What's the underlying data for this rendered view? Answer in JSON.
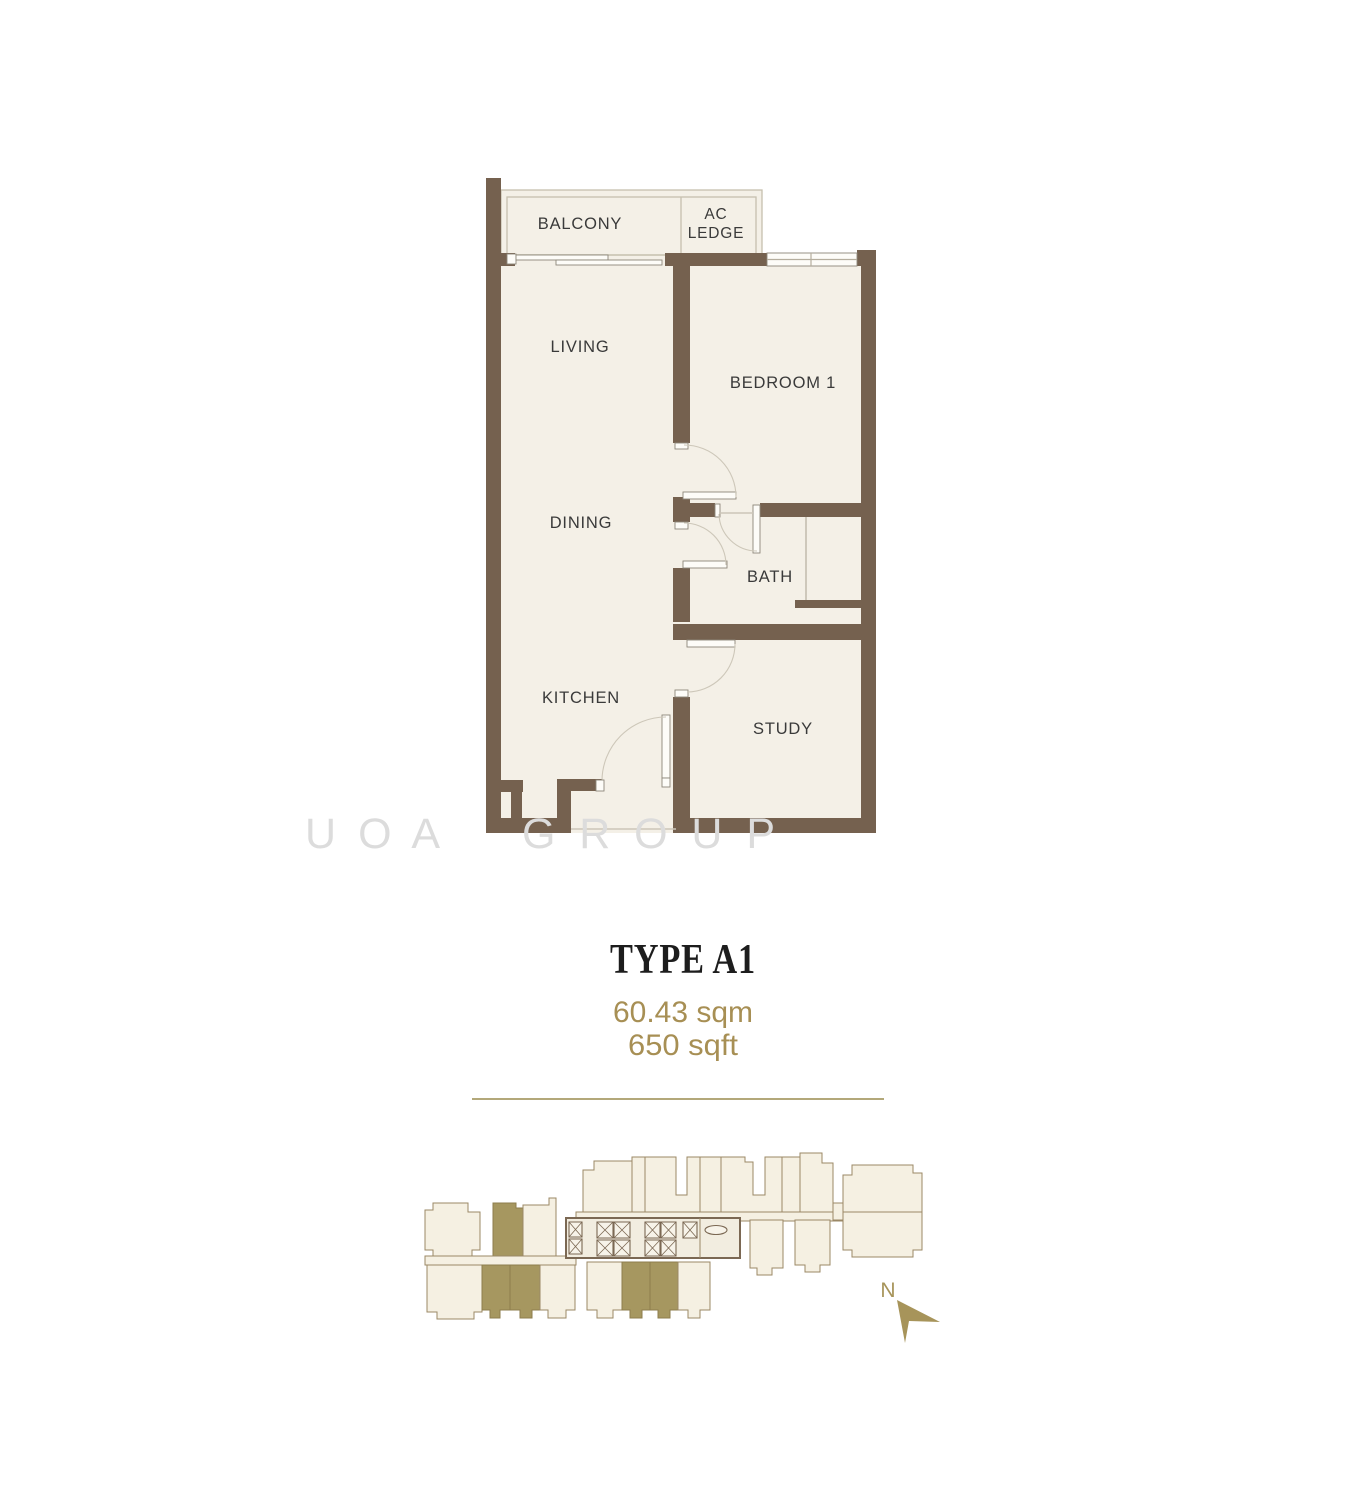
{
  "floor_plan": {
    "labels": {
      "balcony": "BALCONY",
      "ac_ledge_line1": "AC",
      "ac_ledge_line2": "LEDGE",
      "living": "LIVING",
      "bedroom1": "BEDROOM 1",
      "dining": "DINING",
      "bath": "BATH",
      "kitchen": "KITCHEN",
      "study": "STUDY"
    }
  },
  "watermark": {
    "left": "U O A",
    "right": "G R O U P"
  },
  "unit_info": {
    "type_title": "TYPE A1",
    "area_sqm": "60.43 sqm",
    "area_sqft": "650 sqft"
  },
  "key_plan": {
    "north_label": "N"
  },
  "colors": {
    "wall": "#75614f",
    "floor": "#f4f0e7",
    "gold_text": "#a78f54",
    "divider": "#b3a87a",
    "watermark": "#dcdcdc",
    "key_plan_highlight": "#a69760",
    "north": "#a7945a"
  }
}
